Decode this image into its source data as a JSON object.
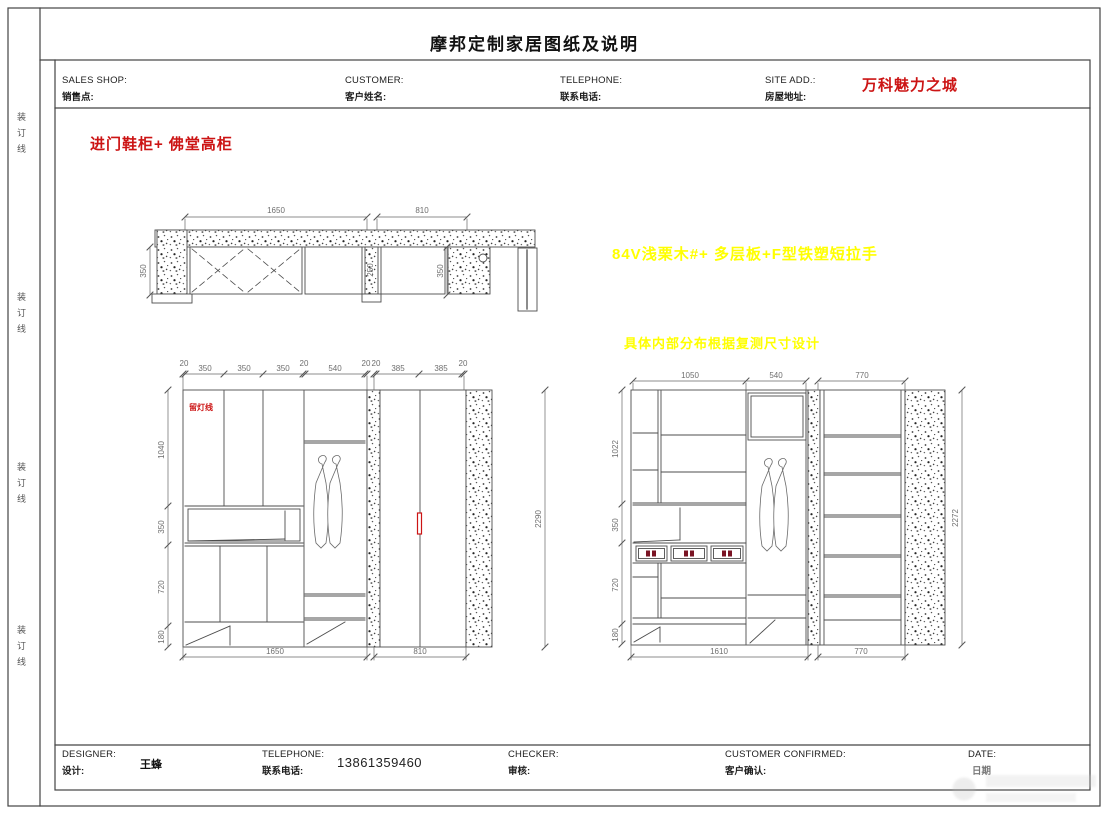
{
  "sheet_title": "摩邦定制家居图纸及说明",
  "binding_line": "装订线",
  "header": {
    "sales_shop_en": "SALES SHOP:",
    "sales_shop_cn": "销售点:",
    "customer_en": "CUSTOMER:",
    "customer_cn": "客户姓名:",
    "telephone_en": "TELEPHONE:",
    "telephone_cn": "联系电话:",
    "site_add_en": "SITE ADD.:",
    "site_add_cn": "房屋地址:",
    "site_value": "万科魅力之城"
  },
  "notes": {
    "cabinet_title": "进门鞋柜+ 佛堂高柜",
    "material_note": "84V浅栗木#+ 多层板+F型铁塑短拉手",
    "layout_note": "具体内部分布根据复测尺寸设计",
    "lamp_note": "留灯线"
  },
  "plan": {
    "dims_top": [
      "1650",
      "810"
    ],
    "dim_left": "350",
    "dims_inner": [
      "250",
      "350"
    ]
  },
  "elevation_left": {
    "dims_top": [
      "20",
      "350",
      "350",
      "350",
      "20",
      "540",
      "20",
      "20",
      "385",
      "385",
      "20"
    ],
    "dims_left": [
      "1040",
      "350",
      "720",
      "180"
    ],
    "dim_right": "2290",
    "dims_bottom": [
      "1650",
      "810"
    ]
  },
  "elevation_right": {
    "dims_top": [
      "1050",
      "540",
      "770"
    ],
    "dims_left": [
      "1022",
      "350",
      "720",
      "180"
    ],
    "dim_right": "2272",
    "dims_bottom": [
      "1610",
      "770"
    ]
  },
  "footer": {
    "designer_en": "DESIGNER:",
    "designer_cn": "设计:",
    "designer_value": "王蜂",
    "telephone_en": "TELEPHONE:",
    "telephone_cn": "联系电话:",
    "telephone_value": "13861359460",
    "checker_en": "CHECKER:",
    "checker_cn": "审核:",
    "confirmed_en": "CUSTOMER CONFIRMED:",
    "confirmed_cn": "客户确认:",
    "date_en": "DATE:",
    "date_cn": "日期"
  },
  "colors": {
    "accent_red": "#cc1414",
    "note_yellow": "#ffff00",
    "line": "#4d4d4d"
  }
}
